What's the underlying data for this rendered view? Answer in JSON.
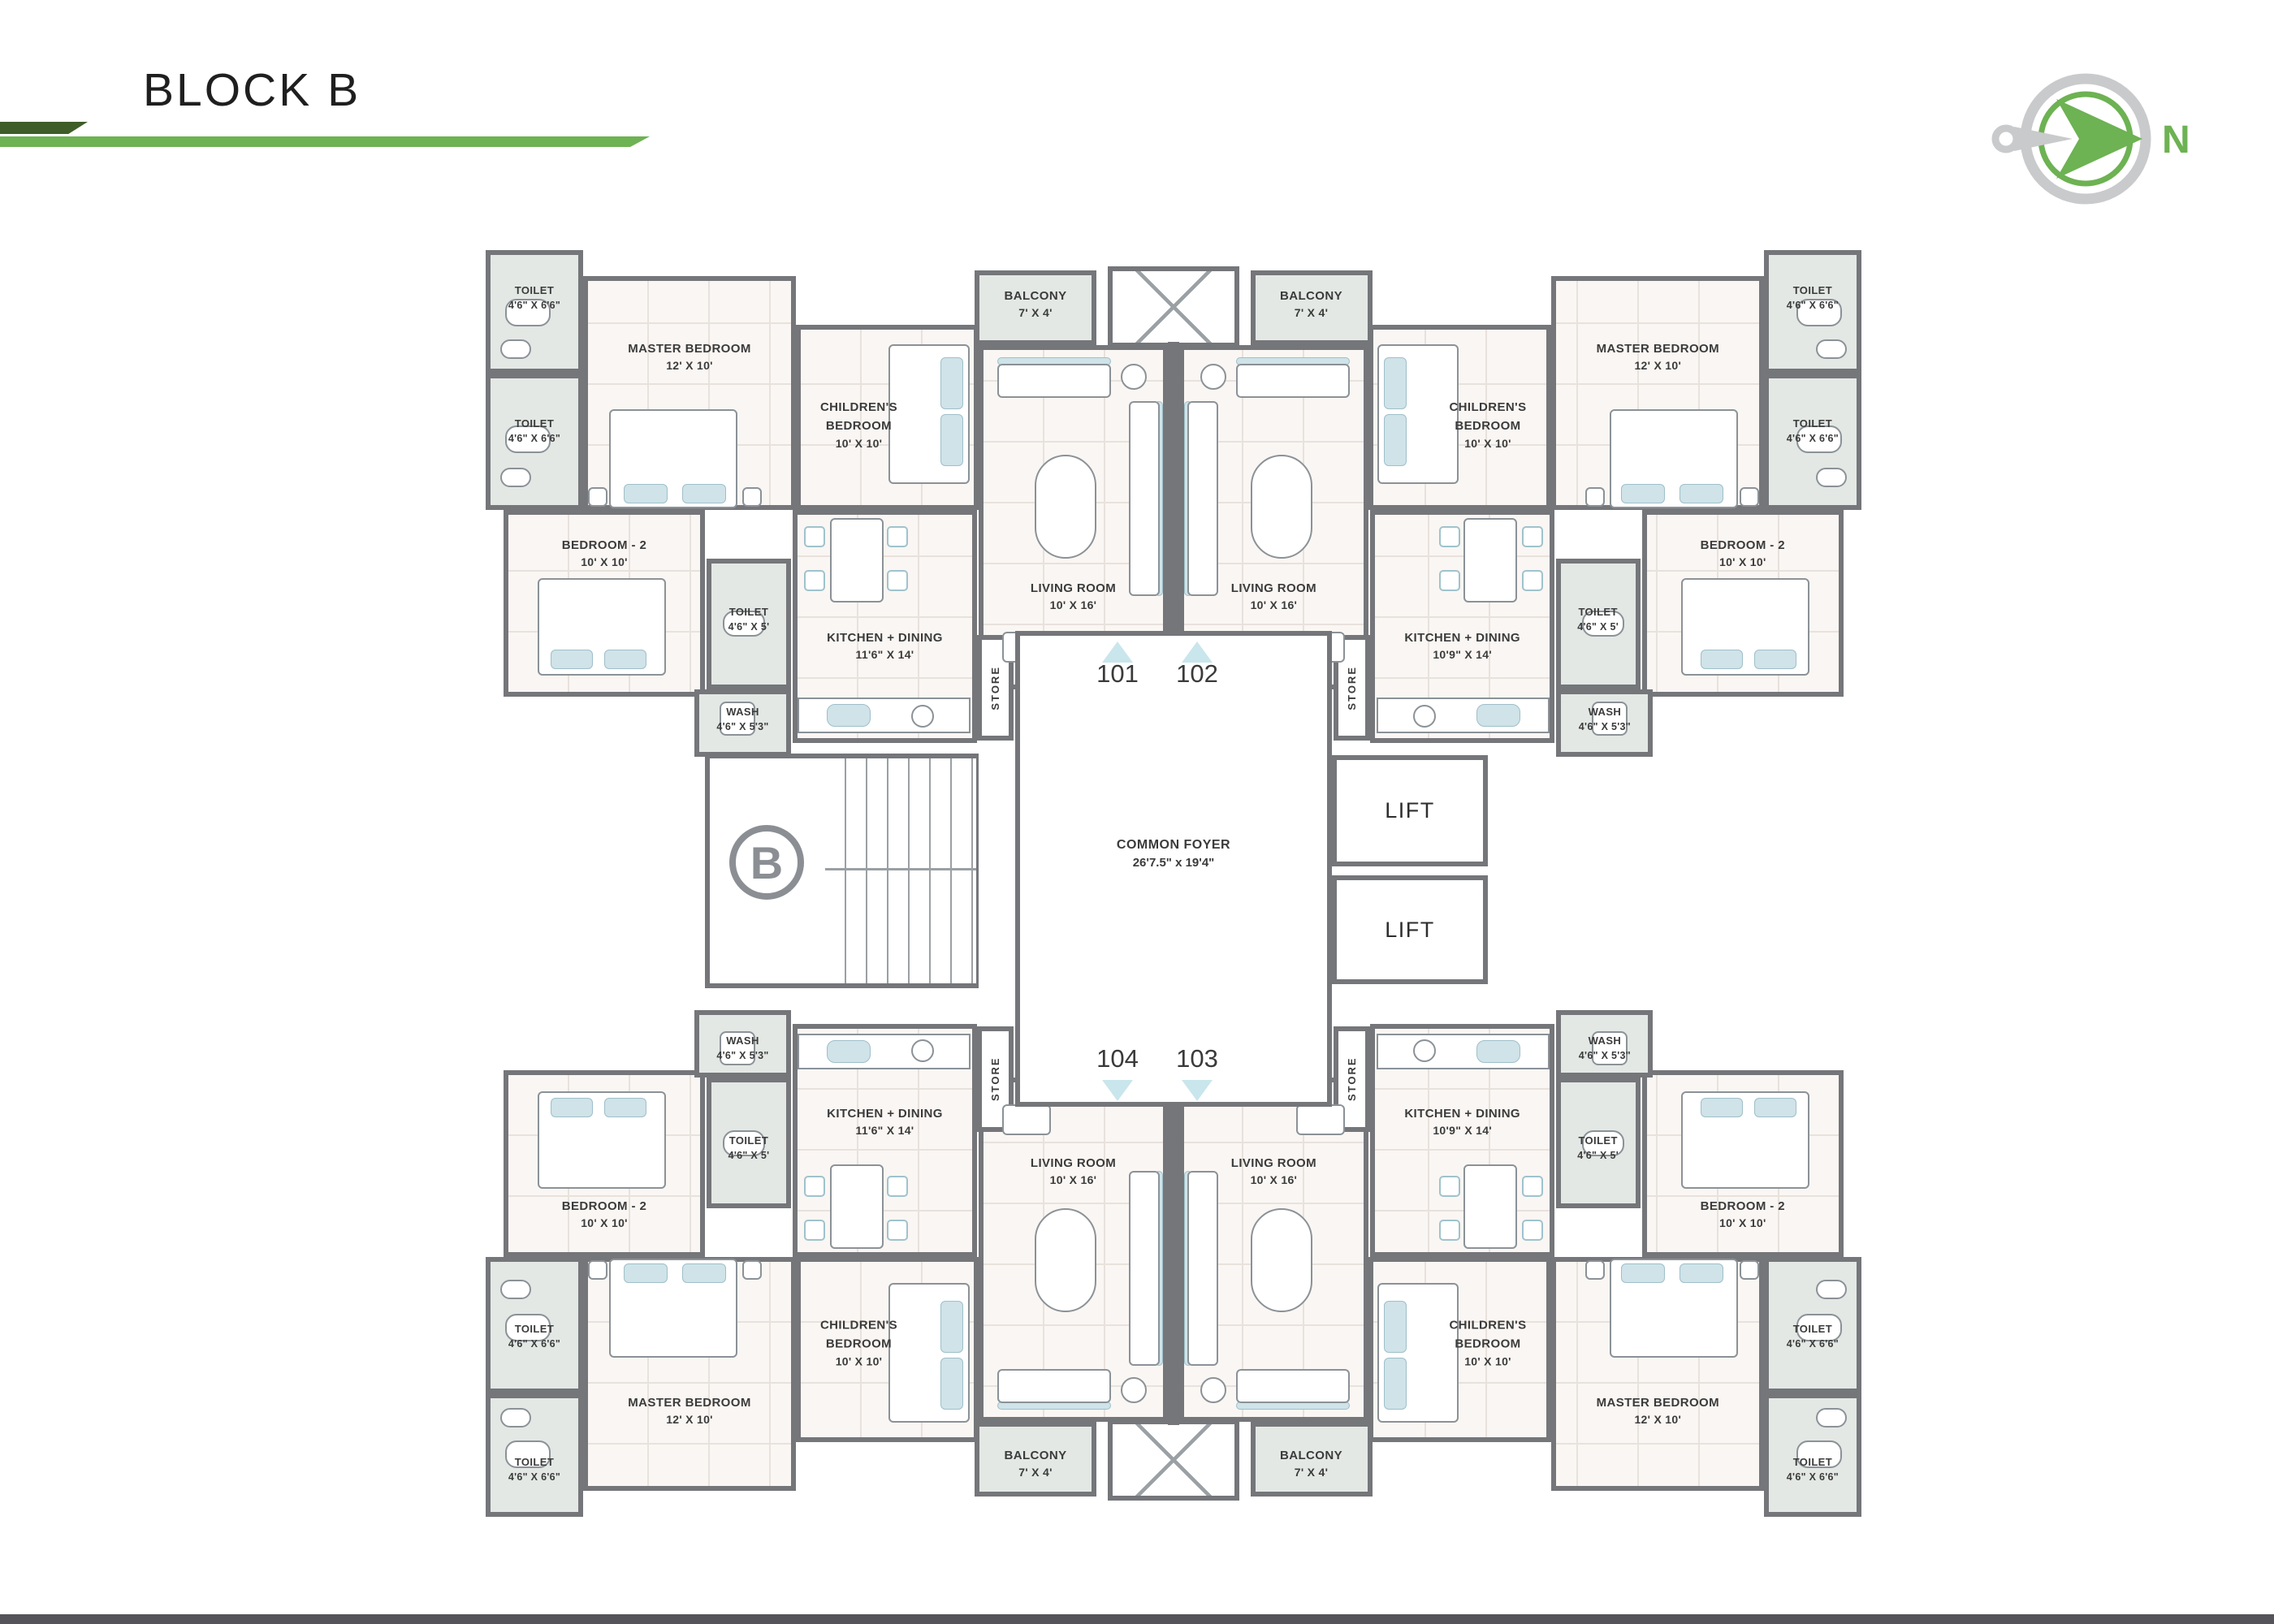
{
  "header": {
    "title": "BLOCK B"
  },
  "compass": {
    "label": "N"
  },
  "colors": {
    "accent_green": "#6db253",
    "dark_green": "#3e5d28",
    "wall_gray": "#75767a",
    "entry_teal": "#c9e6ec"
  },
  "plan": {
    "core": {
      "foyer": {
        "name": "COMMON FOYER",
        "dims": "26'7.5\" x 19'4\""
      },
      "lift_top": "LIFT",
      "lift_bottom": "LIFT",
      "badge": "B"
    },
    "units": [
      {
        "number": "101",
        "position": "top-left",
        "rooms": {
          "toilet_a": {
            "name": "TOILET",
            "dims": "4'6\" X 6'6\""
          },
          "toilet_b": {
            "name": "TOILET",
            "dims": "4'6\" X 6'6\""
          },
          "master": {
            "name": "MASTER BEDROOM",
            "dims": "12' X 10'"
          },
          "children": {
            "name": "CHILDREN'S BEDROOM",
            "dims": "10' X 10'"
          },
          "bedroom2": {
            "name": "BEDROOM - 2",
            "dims": "10' X 10'"
          },
          "toilet_c": {
            "name": "TOILET",
            "dims": "4'6\" X 5'"
          },
          "kitchen": {
            "name": "KITCHEN + DINING",
            "dims": "11'6\" X 14'"
          },
          "wash": {
            "name": "WASH",
            "dims": "4'6\" X 5'3\""
          },
          "living": {
            "name": "LIVING ROOM",
            "dims": "10' X 16'"
          },
          "balcony": {
            "name": "BALCONY",
            "dims": "7' X 4'"
          },
          "store": "STORE"
        }
      },
      {
        "number": "102",
        "position": "top-right",
        "rooms": {
          "toilet_a": {
            "name": "TOILET",
            "dims": "4'6\" X 6'6\""
          },
          "toilet_b": {
            "name": "TOILET",
            "dims": "4'6\" X 6'6\""
          },
          "master": {
            "name": "MASTER BEDROOM",
            "dims": "12' X 10'"
          },
          "children": {
            "name": "CHILDREN'S BEDROOM",
            "dims": "10' X 10'"
          },
          "bedroom2": {
            "name": "BEDROOM - 2",
            "dims": "10' X 10'"
          },
          "toilet_c": {
            "name": "TOILET",
            "dims": "4'6\" X 5'"
          },
          "kitchen": {
            "name": "KITCHEN + DINING",
            "dims": "10'9\" X 14'"
          },
          "wash": {
            "name": "WASH",
            "dims": "4'6\" X 5'3\""
          },
          "living": {
            "name": "LIVING ROOM",
            "dims": "10' X 16'"
          },
          "balcony": {
            "name": "BALCONY",
            "dims": "7' X 4'"
          },
          "store": "STORE"
        }
      },
      {
        "number": "103",
        "position": "bottom-right",
        "rooms": {
          "toilet_a": {
            "name": "TOILET",
            "dims": "4'6\" X 6'6\""
          },
          "toilet_b": {
            "name": "TOILET",
            "dims": "4'6\" X 6'6\""
          },
          "master": {
            "name": "MASTER BEDROOM",
            "dims": "12' X 10'"
          },
          "children": {
            "name": "CHILDREN'S BEDROOM",
            "dims": "10' X 10'"
          },
          "bedroom2": {
            "name": "BEDROOM - 2",
            "dims": "10' X 10'"
          },
          "toilet_c": {
            "name": "TOILET",
            "dims": "4'6\" X 5'"
          },
          "kitchen": {
            "name": "KITCHEN + DINING",
            "dims": "10'9\" X 14'"
          },
          "wash": {
            "name": "WASH",
            "dims": "4'6\" X 5'3\""
          },
          "living": {
            "name": "LIVING ROOM",
            "dims": "10' X 16'"
          },
          "balcony": {
            "name": "BALCONY",
            "dims": "7' X 4'"
          },
          "store": "STORE"
        }
      },
      {
        "number": "104",
        "position": "bottom-left",
        "rooms": {
          "toilet_a": {
            "name": "TOILET",
            "dims": "4'6\" X 6'6\""
          },
          "toilet_b": {
            "name": "TOILET",
            "dims": "4'6\" X 6'6\""
          },
          "master": {
            "name": "MASTER BEDROOM",
            "dims": "12' X 10'"
          },
          "children": {
            "name": "CHILDREN'S BEDROOM",
            "dims": "10' X 10'"
          },
          "bedroom2": {
            "name": "BEDROOM - 2",
            "dims": "10' X 10'"
          },
          "toilet_c": {
            "name": "TOILET",
            "dims": "4'6\" X 5'"
          },
          "kitchen": {
            "name": "KITCHEN + DINING",
            "dims": "11'6\" X 14'"
          },
          "wash": {
            "name": "WASH",
            "dims": "4'6\" X 5'3\""
          },
          "living": {
            "name": "LIVING ROOM",
            "dims": "10' X 16'"
          },
          "balcony": {
            "name": "BALCONY",
            "dims": "7' X 4'"
          },
          "store": "STORE"
        }
      }
    ]
  }
}
